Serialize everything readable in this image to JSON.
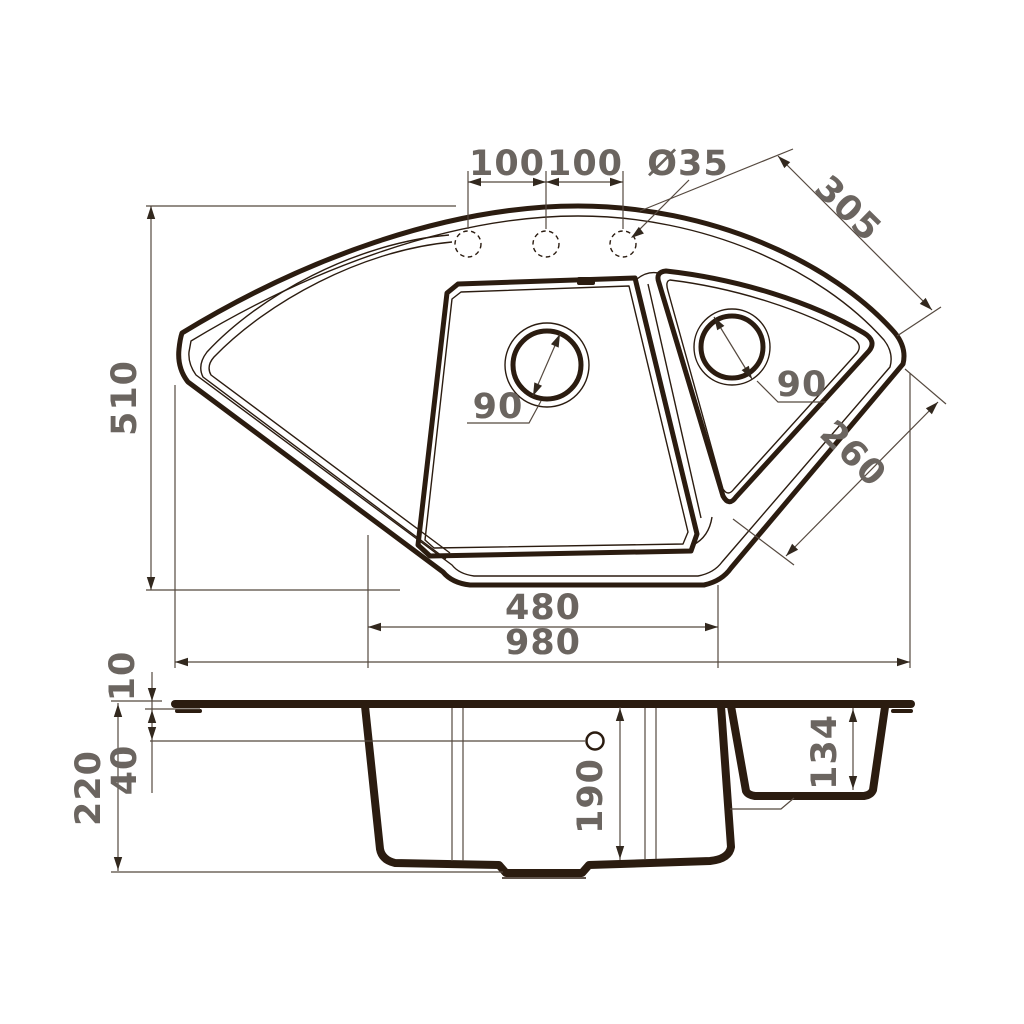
{
  "drawing": {
    "type": "technical-dimension-drawing",
    "subject": "corner-kitchen-sink",
    "views": [
      "top-plan-view",
      "front-section-view"
    ],
    "colors": {
      "background": "#ffffff",
      "outline": "#2b1c10",
      "dimension_lines": "#55493f",
      "dimension_text": "#6b6560"
    }
  },
  "top_view": {
    "dims": {
      "tap_spacing_left": "100",
      "tap_spacing_right": "100",
      "tap_hole_diameter": "Ø35",
      "edge_top_right": "305",
      "depth": "510",
      "main_drain": "90",
      "right_drain": "90",
      "edge_bottom_right": "260",
      "bowl_bottom_width": "480",
      "overall_width": "980"
    },
    "features": {
      "tap_holes": 3,
      "bowls": 2
    }
  },
  "side_view": {
    "dims": {
      "rim_height": "10",
      "overflow_offset": "40",
      "overall_height": "220",
      "main_bowl_depth": "190",
      "right_bowl_depth": "134"
    }
  }
}
